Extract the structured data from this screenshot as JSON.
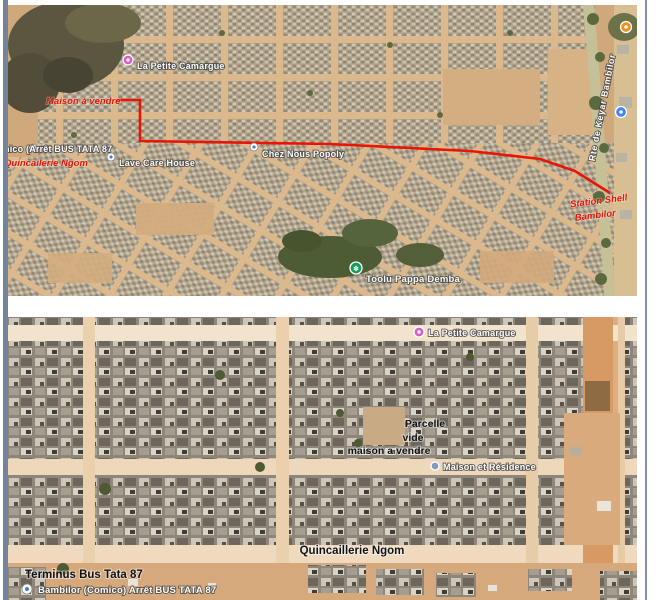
{
  "page": {
    "frame_left_color": "#73849b",
    "frame_right_color": "#7e93b1",
    "background": "#ffffff"
  },
  "pins": {
    "pink": "#d65ec9",
    "green": "#129d5c",
    "blue": "#4285f4",
    "orange": "#ef8f1c",
    "slate": "#7d9cc0"
  },
  "icons": {
    "tree_pin_glyph": "✽"
  },
  "top_map": {
    "route_color": "#ea1400",
    "labels": {
      "la_petite_camargue": "La Petite Camargue",
      "maison_a_vendre": "Maison à vendre",
      "arret_bus_tata": "nico (Arrêt BUS TATA 87",
      "quincailerie_ngom": "Quincailerie Ngom",
      "lave_care_house": "Lave Care House",
      "chez_nous_popoly": "Chez Nous Popoly",
      "toolu_pappa_demba": "Toolu Pappa Demba",
      "rte_de_keyar": "Rte de Keyar Bambilor",
      "station_shell_1": "Station Shell",
      "station_shell_2": "Bambilor"
    }
  },
  "bottom_map": {
    "labels": {
      "la_petite_camargue": "La Petite Camargue",
      "parcelle_1": "Parcelle",
      "parcelle_2": "vide",
      "parcelle_3": "maison a vendre",
      "maison_et_residence": "Maison et Résidence",
      "quincaillerie_ngom": "Quincaillerie Ngom",
      "terminus_bus_tata": "Terminus Bus Tata 87",
      "bambilor_comico": "Bambilor (Comico) Arrêt BUS TATA 87"
    }
  }
}
